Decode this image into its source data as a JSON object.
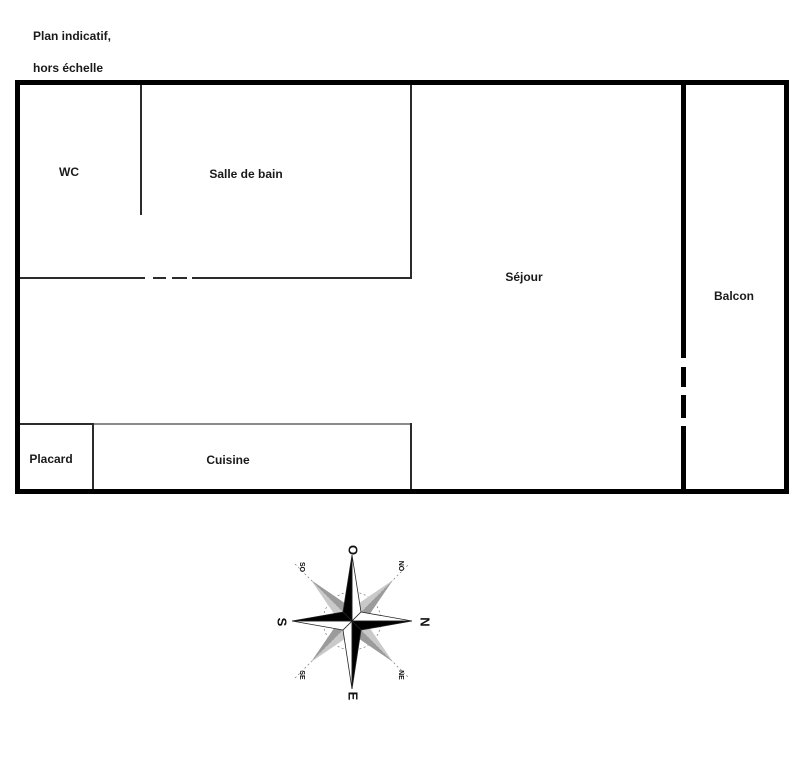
{
  "note": {
    "line1": "Plan indicatif,",
    "line2": "hors échelle"
  },
  "rooms": [
    {
      "id": "wc",
      "label": "WC"
    },
    {
      "id": "salle-de-bain",
      "label": "Salle de bain"
    },
    {
      "id": "sejour",
      "label": "Séjour"
    },
    {
      "id": "balcon",
      "label": "Balcon"
    },
    {
      "id": "placard",
      "label": "Placard"
    },
    {
      "id": "cuisine",
      "label": "Cuisine"
    }
  ],
  "compass": {
    "cardinal": {
      "top": "O",
      "right": "N",
      "bottom": "E",
      "left": "S"
    },
    "intercardinal": {
      "top_left": "SO",
      "top_right": "NO",
      "bottom_left": "SE",
      "bottom_right": "NE"
    }
  },
  "colors": {
    "wall": "#000000",
    "partition": "#2b2b2b",
    "light_partition": "#8a8a8a",
    "text": "#1a1a1a",
    "compass_dark_gray": "#9b9b9b",
    "compass_light_gray": "#c9c9c9"
  }
}
